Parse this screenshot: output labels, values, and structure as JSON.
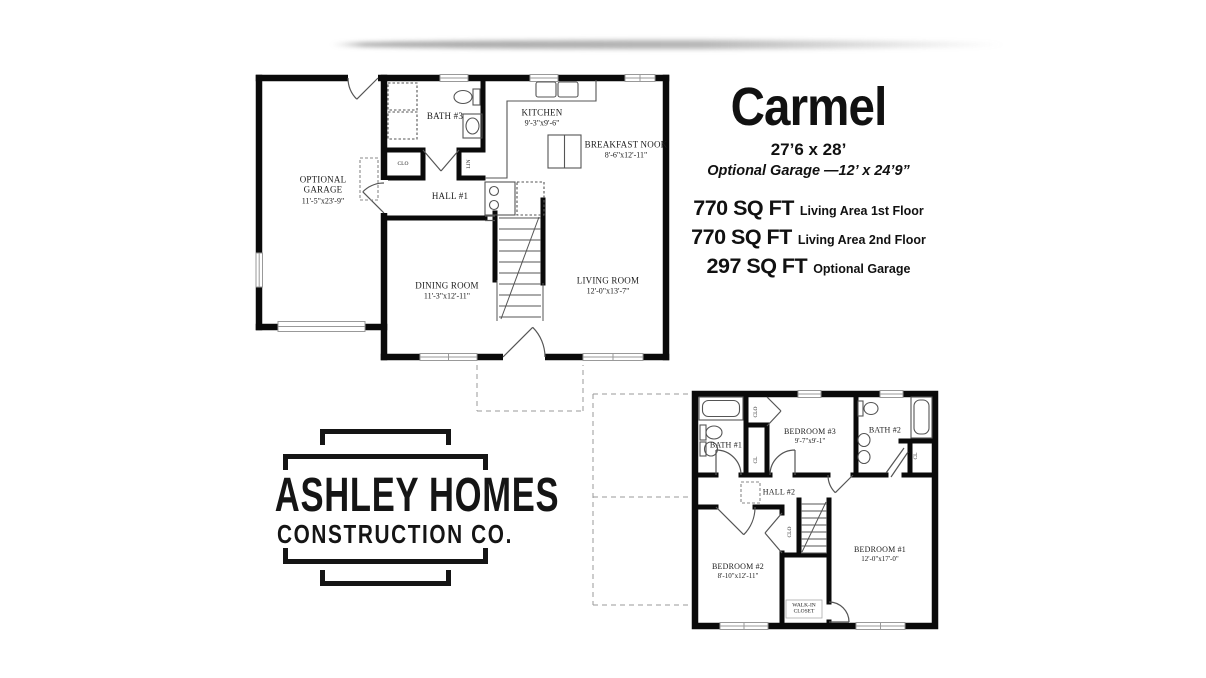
{
  "header": {
    "plan_name": "Carmel",
    "dimensions": "27’6 x 28’",
    "garage_note": "Optional Garage —12’ x 24’9”",
    "areas": [
      {
        "value": "770 SQ FT",
        "label": "Living Area 1st Floor"
      },
      {
        "value": "770 SQ FT",
        "label": "Living Area 2nd Floor"
      },
      {
        "value": "297 SQ FT",
        "label": "Optional Garage"
      }
    ]
  },
  "first_floor": {
    "rooms": {
      "garage": {
        "name": "OPTIONAL GARAGE",
        "dims": "11'-5\"x23'-9\""
      },
      "bath3": {
        "name": "BATH #3"
      },
      "kitchen": {
        "name": "KITCHEN",
        "dims": "9'-3\"x9'-6\""
      },
      "nook": {
        "name": "BREAKFAST NOOK",
        "dims": "8'-6\"x12'-11\""
      },
      "hall": {
        "name": "HALL #1"
      },
      "dining": {
        "name": "DINING ROOM",
        "dims": "11'-3\"x12'-11\""
      },
      "living": {
        "name": "LIVING ROOM",
        "dims": "12'-0\"x13'-7\""
      },
      "clo": "CLO",
      "lin": "LIN"
    }
  },
  "second_floor": {
    "rooms": {
      "bath1": {
        "name": "BATH #1"
      },
      "bed3": {
        "name": "BEDROOM #3",
        "dims": "9'-7\"x9'-1\""
      },
      "bath2": {
        "name": "BATH #2"
      },
      "hall": {
        "name": "HALL #2"
      },
      "bed2": {
        "name": "BEDROOM #2",
        "dims": "8'-10\"x12'-11\""
      },
      "bed1": {
        "name": "BEDROOM #1",
        "dims": "12'-0\"x17'-0\""
      },
      "wic": {
        "name": "WALK-IN CLOSET"
      },
      "clo": "CLO",
      "cl": "CL"
    }
  },
  "logo": {
    "line1": "ASHLEY HOMES",
    "line2": "CONSTRUCTION CO."
  },
  "colors": {
    "wall": "#0a0a0a",
    "thin_line": "#444444",
    "window_frame": "#999999",
    "paper": "#ffffff"
  }
}
